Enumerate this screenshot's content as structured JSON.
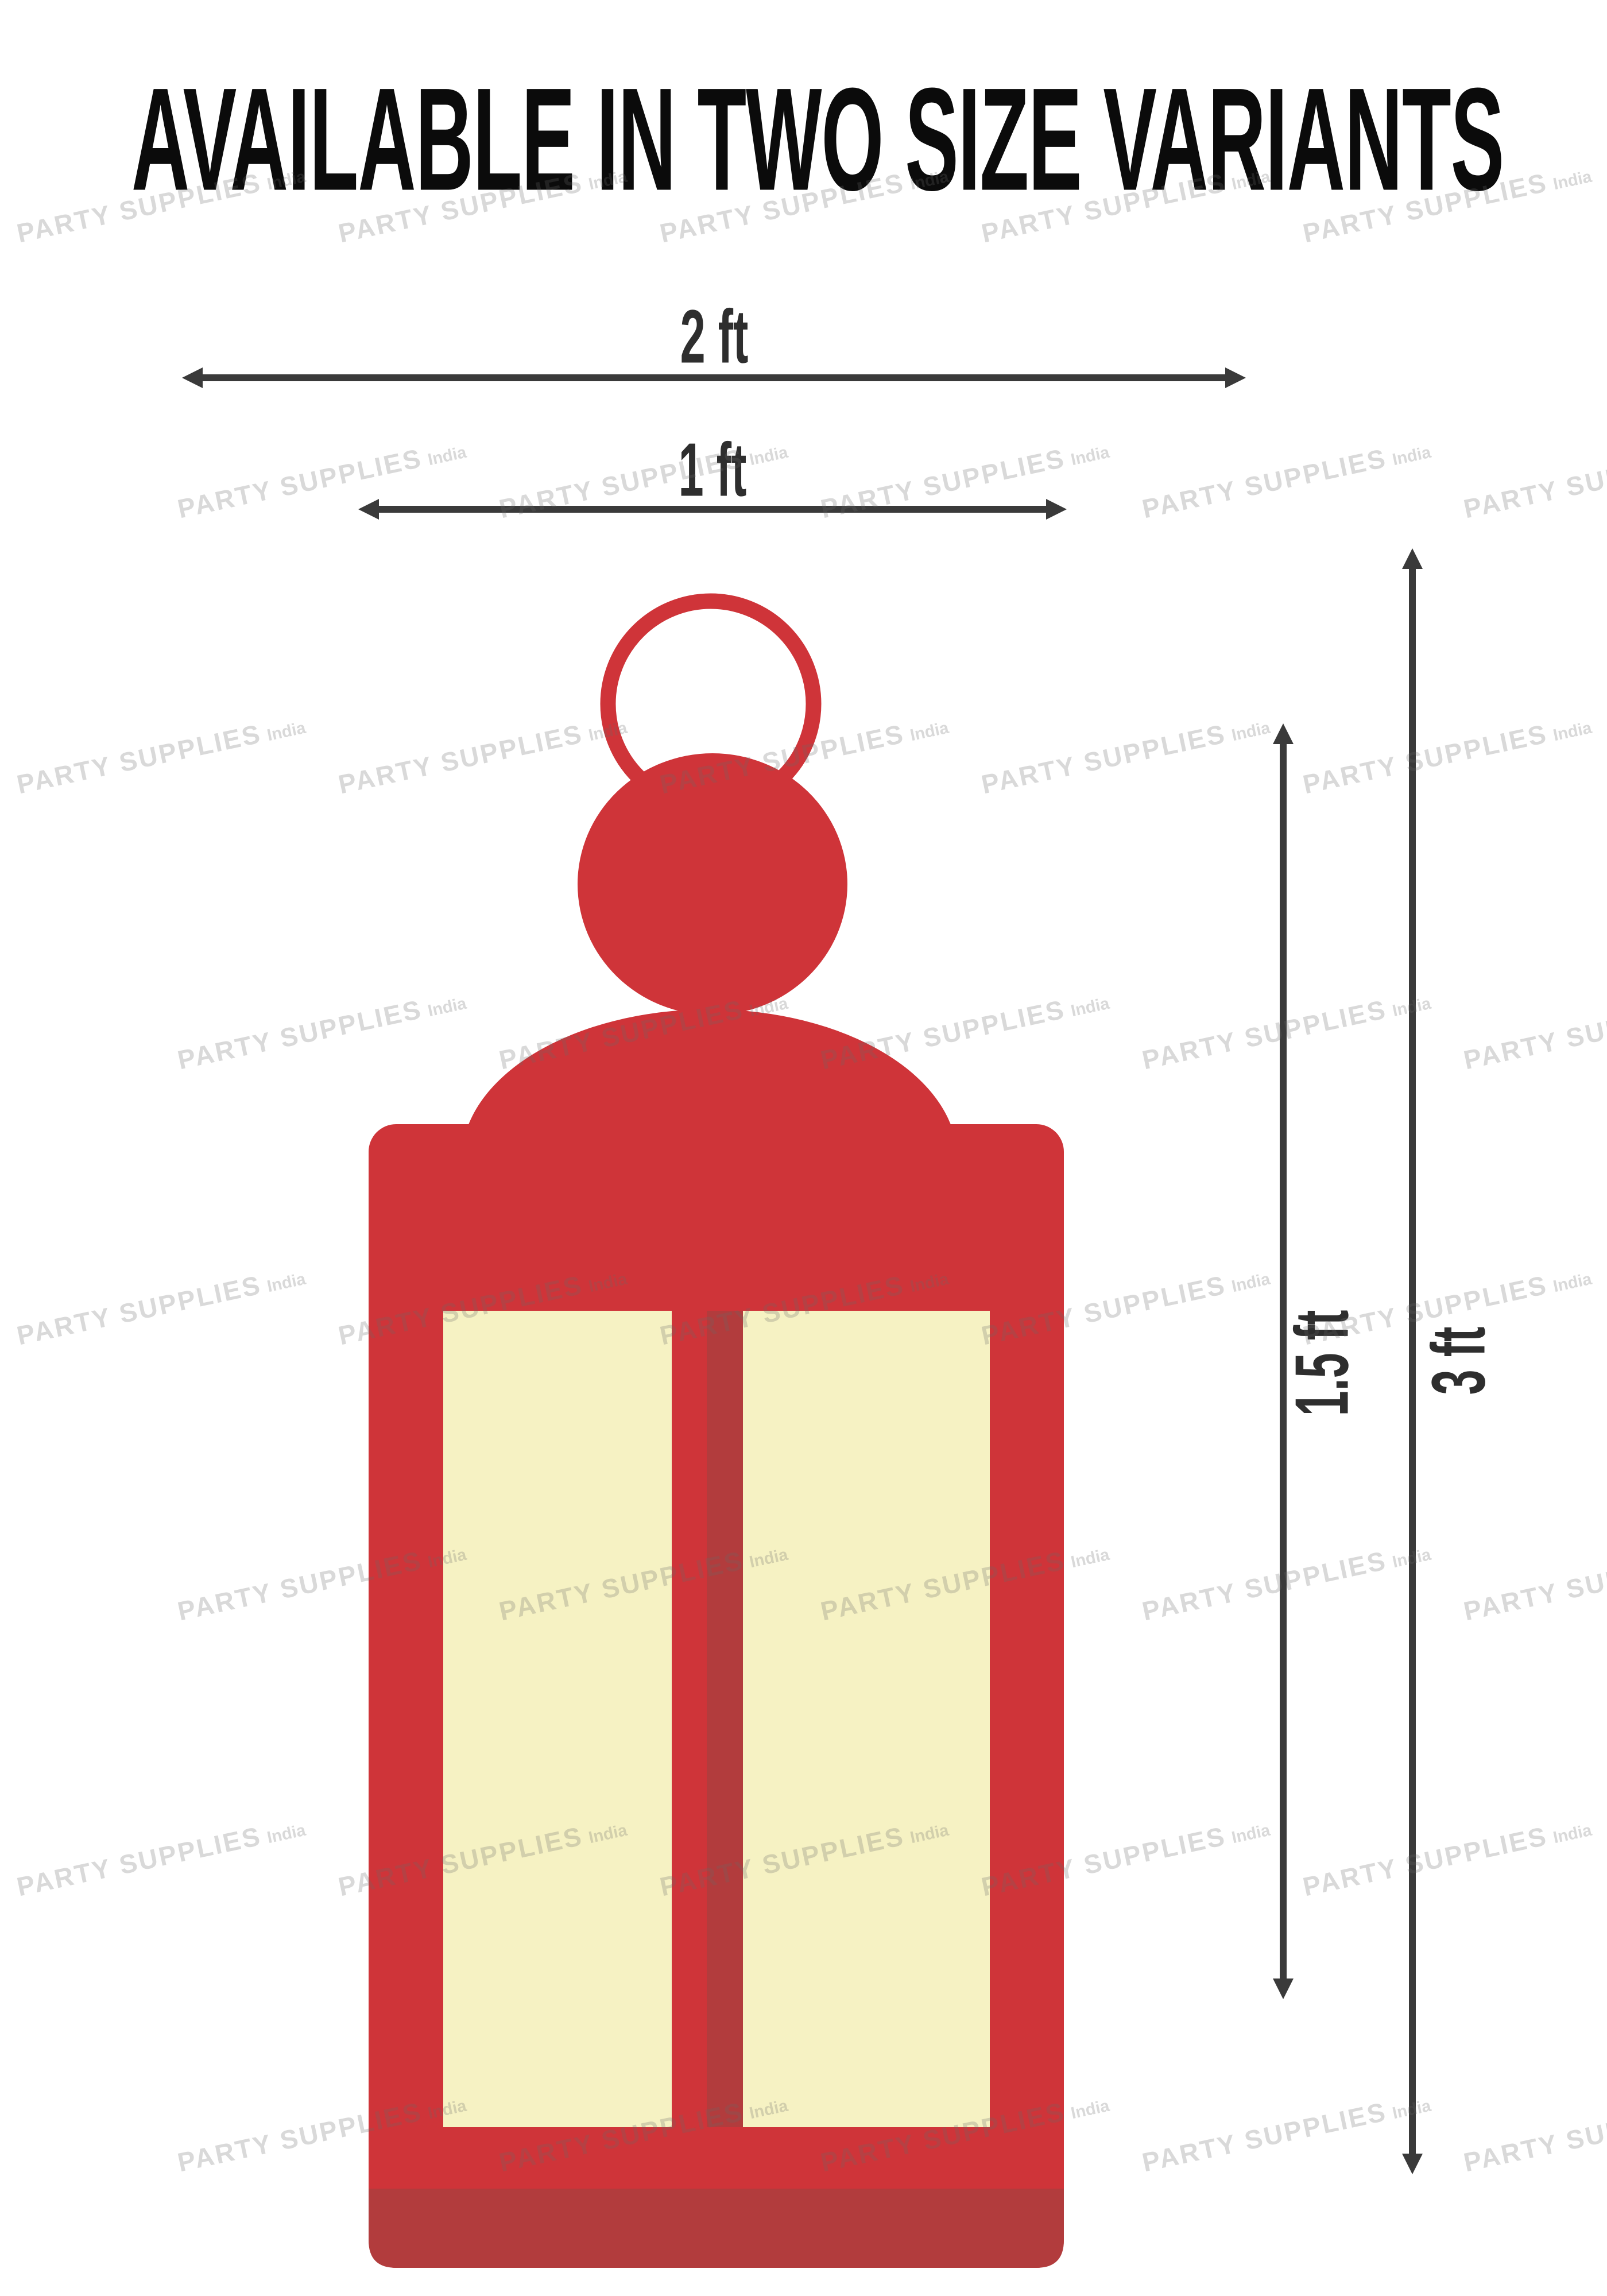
{
  "title": "AVAILABLE IN TWO SIZE VARIANTS",
  "labels": {
    "width_2ft": "2 ft",
    "width_1ft": "1 ft",
    "height_1_5ft": "1.5 ft",
    "height_3ft": "3 ft"
  },
  "watermark": {
    "brand": "PARTY SUPPLIES",
    "region": "India"
  },
  "colors": {
    "lantern_red": "#cf3439",
    "lantern_dark_red": "#b23c3d",
    "panel_cream": "#f6f2c3",
    "arrow_dark": "#3a3a3a",
    "title_black": "#0b0b0b",
    "watermark_gray": "#696969"
  }
}
